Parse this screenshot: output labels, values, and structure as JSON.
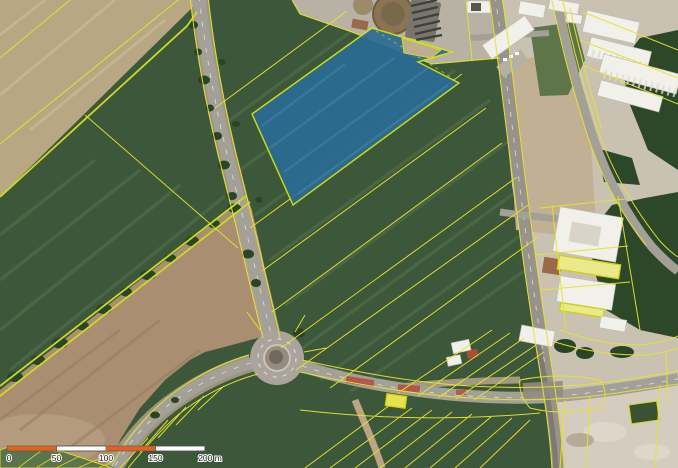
{
  "palette": {
    "green_base": "#3c573a",
    "green_streak": "#54714a",
    "tan_field": "#b7a782",
    "tan_streak": "#c9bb96",
    "brown_field": "#a98e71",
    "brown_streak": "#997e62",
    "brown_light": "#b89f83",
    "blue_parcel": "#2a6c93",
    "blue_streak": "#3b7ba1",
    "cadastral_yellow": "#e6e42a",
    "boundary_yellow": "#c9da25",
    "road_gray": "#a3a098",
    "road_dark": "#97938b",
    "shoulder_tan": "#b4a58b",
    "dash_white": "#eeeee8",
    "industrial": "#c9c2b3",
    "dirt_construction": "#c2b095",
    "dirt_light": "#d4cdbf",
    "dirt_blotch": "#ded7c9",
    "building_white": "#f1f0ea",
    "building_outline": "#bfbcb2",
    "building_yellow": "#ece98a",
    "building_yellow_stroke": "#ccd20e",
    "building_brown": "#996a47",
    "vegetation": "#2d4729",
    "tree_green": "#2a4426",
    "grass_strip": "#5e7449",
    "red_marking": "#b44a3c",
    "label_dark": "#1c1c1c"
  },
  "scalebar": {
    "labels": [
      "0",
      "50",
      "100",
      "150",
      "200 m"
    ],
    "bar_colors": [
      "#e2611c",
      "#ffffff",
      "#e2611c",
      "#ffffff"
    ]
  }
}
